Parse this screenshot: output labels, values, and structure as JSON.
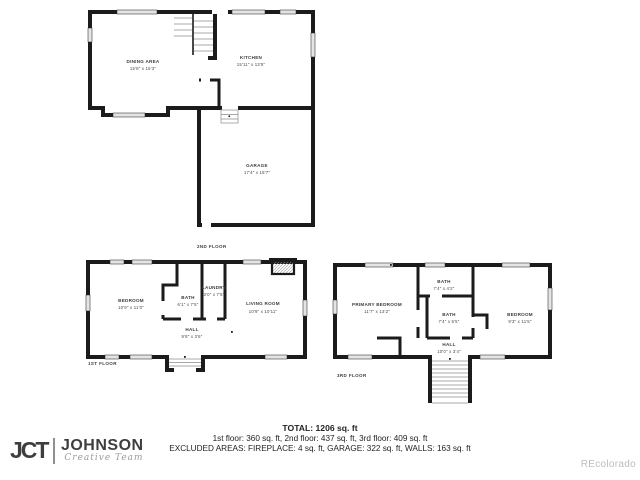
{
  "floors": {
    "floor2": {
      "label": "2ND FLOOR",
      "rooms": {
        "dining": {
          "name": "DINING AREA",
          "dims": "15'8\" x 15'3\""
        },
        "kitchen": {
          "name": "KITCHEN",
          "dims": "15'11\" x 13'5\""
        },
        "garage": {
          "name": "GARAGE",
          "dims": "17'4\" x 18'7\""
        }
      }
    },
    "floor1": {
      "label": "1ST FLOOR",
      "rooms": {
        "bedroom": {
          "name": "BEDROOM",
          "dims": "10'9\" x 11'0\""
        },
        "bath": {
          "name": "BATH",
          "dims": "6'1\" x 7'5\""
        },
        "laundry": {
          "name": "LAUNDRY",
          "dims": "3'0\" x 7'5\""
        },
        "living": {
          "name": "LIVING ROOM",
          "dims": "10'9\" x 10'11\""
        },
        "hall": {
          "name": "HALL",
          "dims": "9'8\" x 3'6\""
        }
      }
    },
    "floor3": {
      "label": "3RD FLOOR",
      "rooms": {
        "primary": {
          "name": "PRIMARY BEDROOM",
          "dims": "11'7\" x 13'2\""
        },
        "bath_top": {
          "name": "BATH",
          "dims": "7'4\" x 4'2\""
        },
        "bath_mid": {
          "name": "BATH",
          "dims": "7'4\" x 5'5\""
        },
        "bedroom": {
          "name": "BEDROOM",
          "dims": "9'3\" x 11'5\""
        },
        "hall": {
          "name": "HALL",
          "dims": "10'0\" x 3'4\""
        }
      }
    }
  },
  "footer": {
    "total": "TOTAL: 1206 sq. ft",
    "floors_line": "1st floor: 360 sq. ft, 2nd floor: 437 sq. ft, 3rd floor: 409 sq. ft",
    "excluded_line": "EXCLUDED AREAS: FIREPLACE: 4 sq. ft, GARAGE: 322 sq. ft, WALLS: 163 sq. ft"
  },
  "logo": {
    "initials": "JCT",
    "name": "JOHNSON",
    "tagline": "Creative Team"
  },
  "watermark": "REcolorado"
}
